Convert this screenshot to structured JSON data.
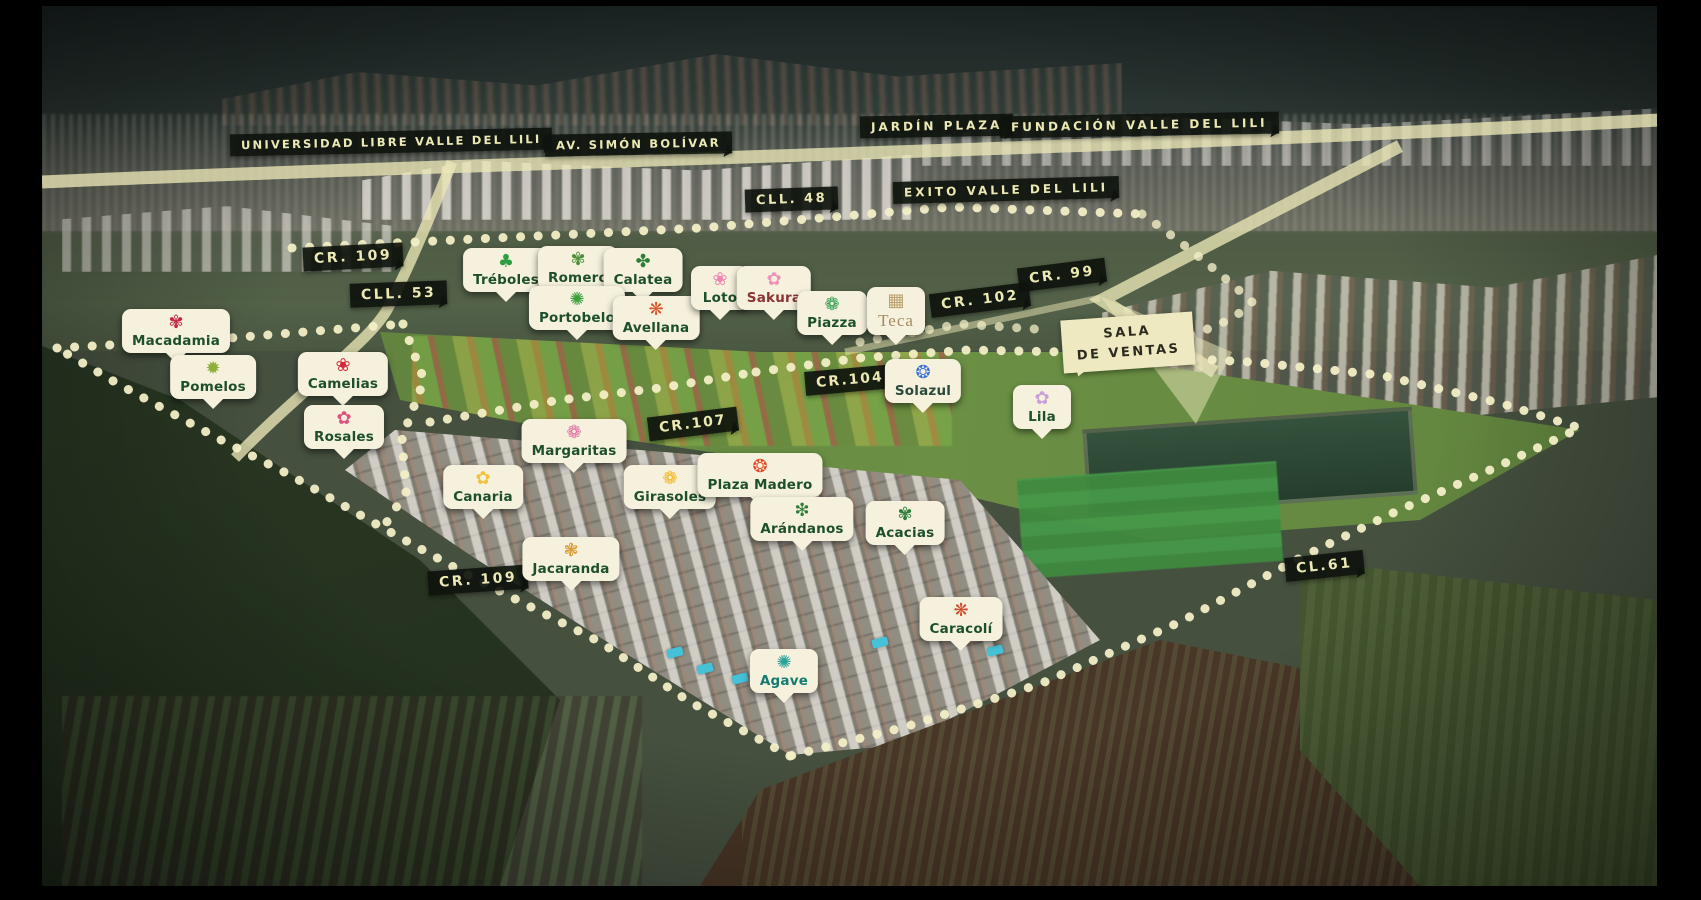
{
  "map": {
    "colors": {
      "road_cream": "#ebe7b6",
      "dot_cream": "#f2eec6",
      "badge_dark_bg": "#0e130d",
      "badge_dark_text": "#ece9b4",
      "marker_bg": "#f5f1dd",
      "marker_text_green": "#1d4f2a"
    },
    "road_labels": [
      {
        "name": "universidad-libre-valle-del-lili",
        "text": "UNIVERSIDAD LIBRE VALLE DEL LILI",
        "x": 230,
        "y": 131,
        "rot": -1.2,
        "fs": 11.5,
        "ls": 2.2
      },
      {
        "name": "av-simon-bolivar",
        "text": "AV. SIMÓN BOLÍVAR",
        "x": 545,
        "y": 133,
        "rot": -1,
        "fs": 11.5,
        "ls": 2.2
      },
      {
        "name": "jardin-plaza",
        "text": "JARDÍN PLAZA",
        "x": 860,
        "y": 115,
        "rot": -1,
        "fs": 12,
        "ls": 3
      },
      {
        "name": "fundacion-valle-del-lili",
        "text": "FUNDACIÓN VALLE DEL LILI",
        "x": 1000,
        "y": 114,
        "rot": -1,
        "fs": 12,
        "ls": 3
      },
      {
        "name": "exito-valle-del-lili",
        "text": "EXITO VALLE DEL LILI",
        "x": 893,
        "y": 179,
        "rot": -1.5,
        "fs": 12,
        "ls": 3
      },
      {
        "name": "cll-48",
        "text": "CLL. 48",
        "x": 745,
        "y": 188,
        "rot": -2,
        "fs": 13,
        "ls": 2.5
      },
      {
        "name": "cr-109-norte",
        "text": "CR. 109",
        "x": 303,
        "y": 245,
        "rot": -3,
        "fs": 14,
        "ls": 2.5
      },
      {
        "name": "cll-53",
        "text": "CLL. 53",
        "x": 350,
        "y": 282,
        "rot": -2,
        "fs": 14,
        "ls": 2.5
      },
      {
        "name": "cr-99",
        "text": "CR. 99",
        "x": 1018,
        "y": 263,
        "rot": -7,
        "fs": 14,
        "ls": 2.5
      },
      {
        "name": "cr-102",
        "text": "CR. 102",
        "x": 930,
        "y": 288,
        "rot": -7,
        "fs": 14,
        "ls": 2.5
      },
      {
        "name": "cr-104",
        "text": "CR.104",
        "x": 805,
        "y": 368,
        "rot": -5,
        "fs": 14,
        "ls": 2
      },
      {
        "name": "cr-107",
        "text": "CR.107",
        "x": 648,
        "y": 412,
        "rot": -7,
        "fs": 14,
        "ls": 2
      },
      {
        "name": "cr-109-sur",
        "text": "CR. 109",
        "x": 428,
        "y": 568,
        "rot": -4,
        "fs": 14,
        "ls": 2.5
      },
      {
        "name": "cl-61",
        "text": "CL.61",
        "x": 1285,
        "y": 554,
        "rot": -6,
        "fs": 14,
        "ls": 2.5
      }
    ],
    "sales_room": {
      "line1": "SALA",
      "line2": "DE VENTAS",
      "x": 1062,
      "y": 316,
      "rot": -4
    },
    "markers": [
      {
        "name": "treboles",
        "label": "Tréboles",
        "x": 506,
        "y": 248,
        "glyph": "♣",
        "glyph_color": "#2e9e45"
      },
      {
        "name": "romero",
        "label": "Romero",
        "x": 578,
        "y": 246,
        "glyph": "✾",
        "glyph_color": "#4c8f38"
      },
      {
        "name": "calatea",
        "label": "Calatea",
        "x": 643,
        "y": 248,
        "glyph": "✤",
        "glyph_color": "#2f7d3a"
      },
      {
        "name": "portobelo",
        "label": "Portobelo",
        "x": 577,
        "y": 286,
        "glyph": "✺",
        "glyph_color": "#3aa03a"
      },
      {
        "name": "avellana",
        "label": "Avellana",
        "x": 656,
        "y": 296,
        "glyph": "❋",
        "glyph_color": "#d9542b"
      },
      {
        "name": "loto",
        "label": "Loto",
        "x": 720,
        "y": 266,
        "glyph": "❀",
        "glyph_color": "#ef86b2"
      },
      {
        "name": "sakura",
        "label": "Sakura",
        "x": 774,
        "y": 266,
        "glyph": "✿",
        "glyph_color": "#ee93ba",
        "label_color": "#8a3434"
      },
      {
        "name": "piazza",
        "label": "Piazza",
        "x": 832,
        "y": 291,
        "glyph": "❁",
        "glyph_color": "#2e9e4f"
      },
      {
        "name": "teca",
        "label": "Teca",
        "x": 896,
        "y": 287,
        "glyph": "▦",
        "glyph_color": "#b9a06a",
        "label_color": "#a38d60",
        "serif": true
      },
      {
        "name": "macadamia",
        "label": "Macadamia",
        "x": 176,
        "y": 309,
        "glyph": "✾",
        "glyph_color": "#c22744"
      },
      {
        "name": "pomelos",
        "label": "Pomelos",
        "x": 213,
        "y": 355,
        "glyph": "✹",
        "glyph_color": "#8fae3a"
      },
      {
        "name": "camelias",
        "label": "Camelias",
        "x": 343,
        "y": 352,
        "glyph": "❀",
        "glyph_color": "#d42a3d"
      },
      {
        "name": "rosales",
        "label": "Rosales",
        "x": 344,
        "y": 405,
        "glyph": "✿",
        "glyph_color": "#e0527e"
      },
      {
        "name": "margaritas",
        "label": "Margaritas",
        "x": 574,
        "y": 419,
        "glyph": "❁",
        "glyph_color": "#e06fa4"
      },
      {
        "name": "solazul",
        "label": "Solazul",
        "x": 923,
        "y": 359,
        "glyph": "❂",
        "glyph_color": "#3a6fd8",
        "label_color": "#2b4a3e"
      },
      {
        "name": "lila",
        "label": "Lila",
        "x": 1042,
        "y": 385,
        "glyph": "✿",
        "glyph_color": "#c9a0d8"
      },
      {
        "name": "canaria",
        "label": "Canaria",
        "x": 483,
        "y": 465,
        "glyph": "✿",
        "glyph_color": "#f2c23e"
      },
      {
        "name": "girasoles",
        "label": "Girasoles",
        "x": 670,
        "y": 465,
        "glyph": "❁",
        "glyph_color": "#f2b824"
      },
      {
        "name": "plaza-madero",
        "label": "Plaza Madero",
        "x": 760,
        "y": 453,
        "glyph": "❂",
        "glyph_color": "#e04826"
      },
      {
        "name": "arandanos",
        "label": "Arándanos",
        "x": 802,
        "y": 497,
        "glyph": "❇",
        "glyph_color": "#2f7d3a"
      },
      {
        "name": "acacias",
        "label": "Acacias",
        "x": 905,
        "y": 501,
        "glyph": "✾",
        "glyph_color": "#2f7d3a"
      },
      {
        "name": "jacaranda",
        "label": "Jacaranda",
        "x": 571,
        "y": 537,
        "glyph": "❃",
        "glyph_color": "#d9972f"
      },
      {
        "name": "caracoli",
        "label": "Caracolí",
        "x": 961,
        "y": 597,
        "glyph": "❋",
        "glyph_color": "#d04a2a"
      },
      {
        "name": "agave",
        "label": "Agave",
        "x": 784,
        "y": 649,
        "glyph": "✺",
        "glyph_color": "#2aa398",
        "label_color": "#157a70"
      }
    ]
  }
}
